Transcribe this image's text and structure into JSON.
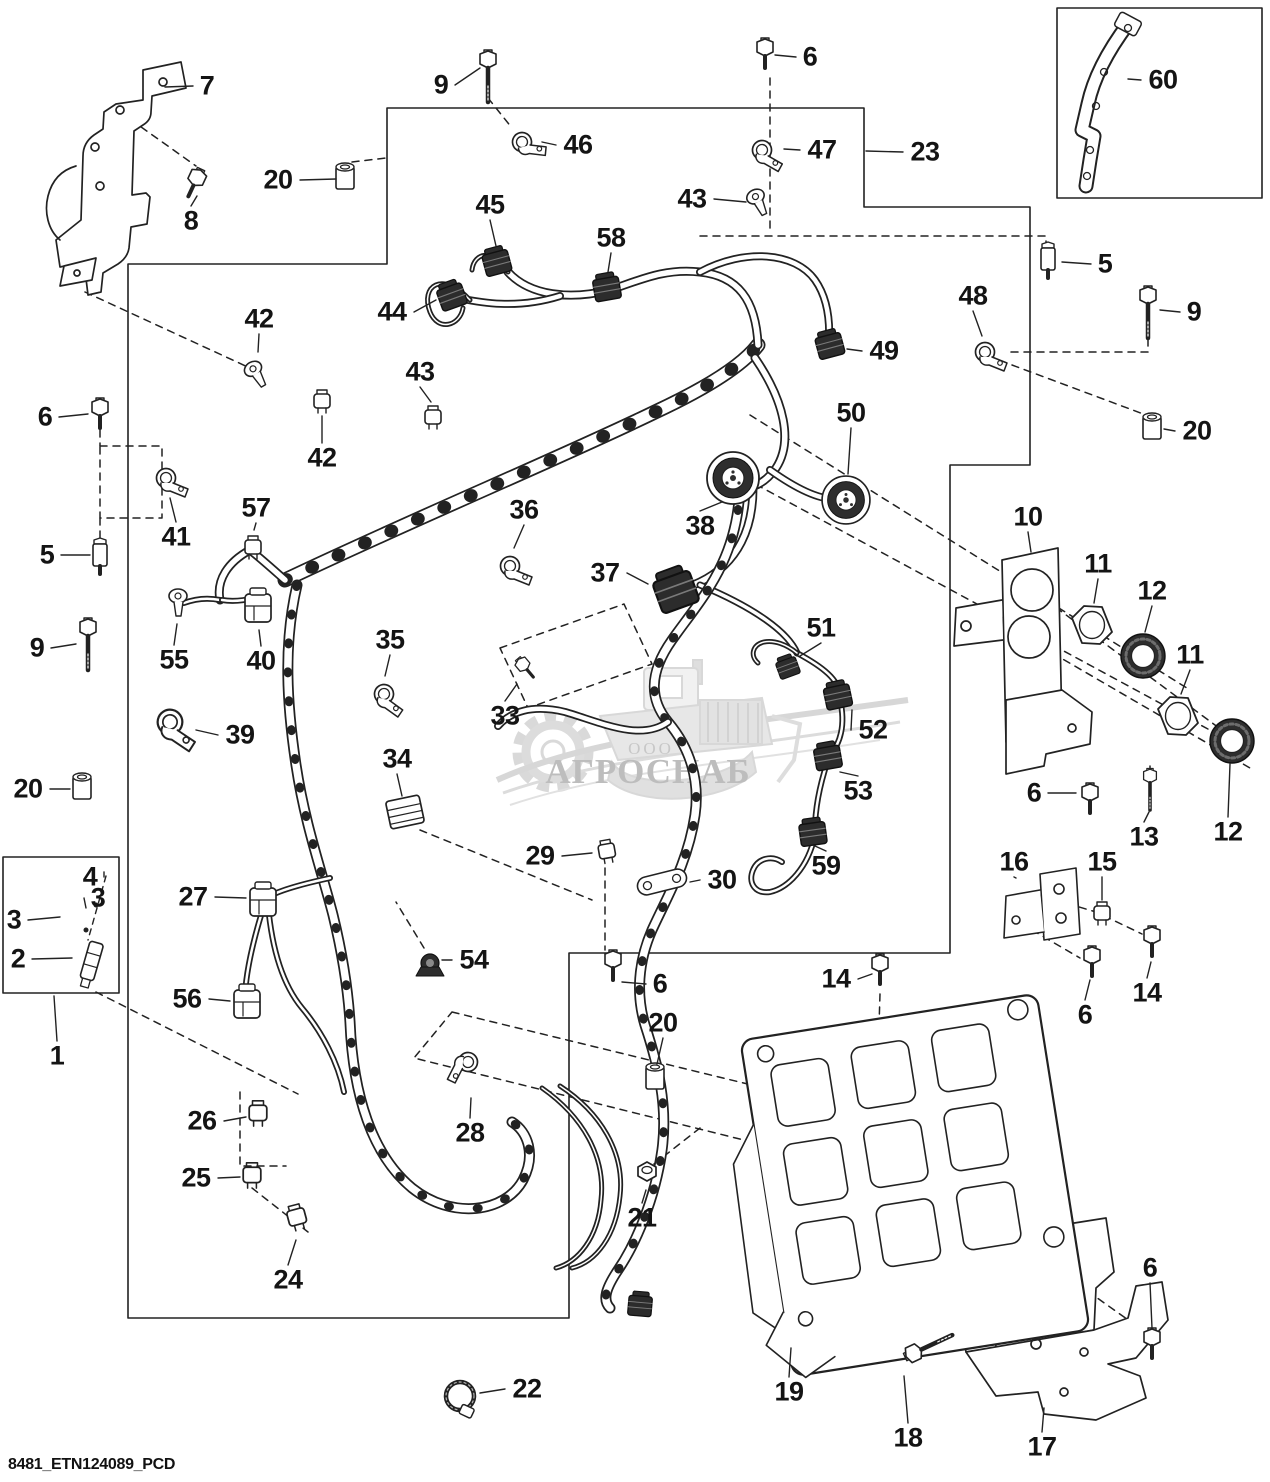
{
  "page": {
    "footer_code": "8481_ETN124089_PCD"
  },
  "watermark": {
    "company_prefix": "ООО",
    "company_name": "АГРОСНАБ"
  },
  "diagram": {
    "callouts": [
      {
        "t": "7",
        "x": 207,
        "y": 86,
        "lx": 165,
        "ly": 87
      },
      {
        "t": "9",
        "x": 441,
        "y": 85,
        "lx": 480,
        "ly": 68
      },
      {
        "t": "6",
        "x": 810,
        "y": 57,
        "lx": 775,
        "ly": 55
      },
      {
        "t": "60",
        "x": 1163,
        "y": 80,
        "lx": 1128,
        "ly": 79
      },
      {
        "t": "46",
        "x": 578,
        "y": 145,
        "lx": 542,
        "ly": 142
      },
      {
        "t": "47",
        "x": 822,
        "y": 150,
        "lx": 784,
        "ly": 149
      },
      {
        "t": "23",
        "x": 925,
        "y": 152,
        "lx": 866,
        "ly": 151
      },
      {
        "t": "20",
        "x": 278,
        "y": 180,
        "lx": 336,
        "ly": 179
      },
      {
        "t": "8",
        "x": 191,
        "y": 221,
        "lx": 197,
        "ly": 196
      },
      {
        "t": "43",
        "x": 692,
        "y": 199,
        "lx": 746,
        "ly": 202
      },
      {
        "t": "45",
        "x": 490,
        "y": 205,
        "lx": 496,
        "ly": 246
      },
      {
        "t": "58",
        "x": 611,
        "y": 238,
        "lx": 608,
        "ly": 272
      },
      {
        "t": "5",
        "x": 1105,
        "y": 264,
        "lx": 1062,
        "ly": 262
      },
      {
        "t": "48",
        "x": 973,
        "y": 296,
        "lx": 982,
        "ly": 336
      },
      {
        "t": "9",
        "x": 1194,
        "y": 312,
        "lx": 1160,
        "ly": 310
      },
      {
        "t": "42",
        "x": 259,
        "y": 319,
        "lx": 258,
        "ly": 352
      },
      {
        "t": "44",
        "x": 392,
        "y": 312,
        "lx": 436,
        "ly": 300
      },
      {
        "t": "43",
        "x": 420,
        "y": 372,
        "lx": 431,
        "ly": 402
      },
      {
        "t": "49",
        "x": 884,
        "y": 351,
        "lx": 847,
        "ly": 349
      },
      {
        "t": "50",
        "x": 851,
        "y": 413,
        "lx": 848,
        "ly": 474
      },
      {
        "t": "42",
        "x": 322,
        "y": 458,
        "lx": 322,
        "ly": 416
      },
      {
        "t": "6",
        "x": 45,
        "y": 417,
        "lx": 88,
        "ly": 414
      },
      {
        "t": "20",
        "x": 1197,
        "y": 431,
        "lx": 1164,
        "ly": 429
      },
      {
        "t": "57",
        "x": 256,
        "y": 508,
        "lx": 254,
        "ly": 530
      },
      {
        "t": "41",
        "x": 176,
        "y": 537,
        "lx": 170,
        "ly": 498
      },
      {
        "t": "36",
        "x": 524,
        "y": 510,
        "lx": 514,
        "ly": 548
      },
      {
        "t": "10",
        "x": 1028,
        "y": 517,
        "lx": 1031,
        "ly": 552
      },
      {
        "t": "5",
        "x": 47,
        "y": 555,
        "lx": 90,
        "ly": 555
      },
      {
        "t": "11",
        "x": 1098,
        "y": 564,
        "lx": 1094,
        "ly": 603
      },
      {
        "t": "12",
        "x": 1152,
        "y": 591,
        "lx": 1145,
        "ly": 632
      },
      {
        "t": "37",
        "x": 605,
        "y": 573,
        "lx": 648,
        "ly": 584
      },
      {
        "t": "38",
        "x": 700,
        "y": 526,
        "lx": 722,
        "ly": 502
      },
      {
        "t": "55",
        "x": 174,
        "y": 660,
        "lx": 177,
        "ly": 624
      },
      {
        "t": "40",
        "x": 261,
        "y": 661,
        "lx": 259,
        "ly": 630
      },
      {
        "t": "11",
        "x": 1190,
        "y": 655,
        "lx": 1181,
        "ly": 694
      },
      {
        "t": "9",
        "x": 37,
        "y": 648,
        "lx": 76,
        "ly": 644
      },
      {
        "t": "35",
        "x": 390,
        "y": 640,
        "lx": 385,
        "ly": 676
      },
      {
        "t": "51",
        "x": 821,
        "y": 628,
        "lx": 800,
        "ly": 656
      },
      {
        "t": "33",
        "x": 505,
        "y": 716,
        "lx": 517,
        "ly": 684
      },
      {
        "t": "52",
        "x": 873,
        "y": 730,
        "lx": 852,
        "ly": 710
      },
      {
        "t": "39",
        "x": 240,
        "y": 735,
        "lx": 196,
        "ly": 730
      },
      {
        "t": "12",
        "x": 1228,
        "y": 832,
        "lx": 1230,
        "ly": 764
      },
      {
        "t": "6",
        "x": 1034,
        "y": 793,
        "lx": 1076,
        "ly": 793
      },
      {
        "t": "53",
        "x": 858,
        "y": 791,
        "lx": 840,
        "ly": 772
      },
      {
        "t": "20",
        "x": 28,
        "y": 789,
        "lx": 70,
        "ly": 789
      },
      {
        "t": "34",
        "x": 397,
        "y": 759,
        "lx": 402,
        "ly": 796
      },
      {
        "t": "13",
        "x": 1144,
        "y": 837,
        "lx": 1149,
        "ly": 812
      },
      {
        "t": "29",
        "x": 540,
        "y": 856,
        "lx": 592,
        "ly": 853
      },
      {
        "t": "30",
        "x": 722,
        "y": 880,
        "lx": 690,
        "ly": 882
      },
      {
        "t": "59",
        "x": 826,
        "y": 866,
        "lx": 815,
        "ly": 846
      },
      {
        "t": "16",
        "x": 1014,
        "y": 862,
        "lx": 1016,
        "ly": 878
      },
      {
        "t": "15",
        "x": 1102,
        "y": 862,
        "lx": 1102,
        "ly": 900
      },
      {
        "t": "4",
        "x": 90,
        "y": 877,
        "lx": 104,
        "ly": 872
      },
      {
        "t": "3",
        "x": 98,
        "y": 898,
        "lx": 86,
        "ly": 908
      },
      {
        "t": "3",
        "x": 14,
        "y": 920,
        "lx": 60,
        "ly": 917
      },
      {
        "t": "2",
        "x": 18,
        "y": 959,
        "lx": 72,
        "ly": 958
      },
      {
        "t": "27",
        "x": 193,
        "y": 897,
        "lx": 246,
        "ly": 898
      },
      {
        "t": "6",
        "x": 660,
        "y": 984,
        "lx": 622,
        "ly": 982
      },
      {
        "t": "14",
        "x": 836,
        "y": 979,
        "lx": 872,
        "ly": 974
      },
      {
        "t": "6",
        "x": 1085,
        "y": 1015,
        "lx": 1090,
        "ly": 980
      },
      {
        "t": "14",
        "x": 1147,
        "y": 993,
        "lx": 1151,
        "ly": 962
      },
      {
        "t": "54",
        "x": 474,
        "y": 960,
        "lx": 442,
        "ly": 960
      },
      {
        "t": "56",
        "x": 187,
        "y": 999,
        "lx": 230,
        "ly": 1001
      },
      {
        "t": "20",
        "x": 663,
        "y": 1023,
        "lx": 657,
        "ly": 1064
      },
      {
        "t": "1",
        "x": 57,
        "y": 1056,
        "lx": 54,
        "ly": 996
      },
      {
        "t": "26",
        "x": 202,
        "y": 1121,
        "lx": 246,
        "ly": 1117
      },
      {
        "t": "28",
        "x": 470,
        "y": 1133,
        "lx": 471,
        "ly": 1098
      },
      {
        "t": "25",
        "x": 196,
        "y": 1178,
        "lx": 240,
        "ly": 1177
      },
      {
        "t": "24",
        "x": 288,
        "y": 1280,
        "lx": 296,
        "ly": 1240
      },
      {
        "t": "21",
        "x": 642,
        "y": 1218,
        "lx": 646,
        "ly": 1190
      },
      {
        "t": "22",
        "x": 527,
        "y": 1389,
        "lx": 480,
        "ly": 1393
      },
      {
        "t": "6",
        "x": 1150,
        "y": 1268,
        "lx": 1152,
        "ly": 1328
      },
      {
        "t": "19",
        "x": 789,
        "y": 1392,
        "lx": 791,
        "ly": 1348
      },
      {
        "t": "18",
        "x": 908,
        "y": 1438,
        "lx": 904,
        "ly": 1376
      },
      {
        "t": "17",
        "x": 1042,
        "y": 1447,
        "lx": 1044,
        "ly": 1408
      }
    ]
  }
}
